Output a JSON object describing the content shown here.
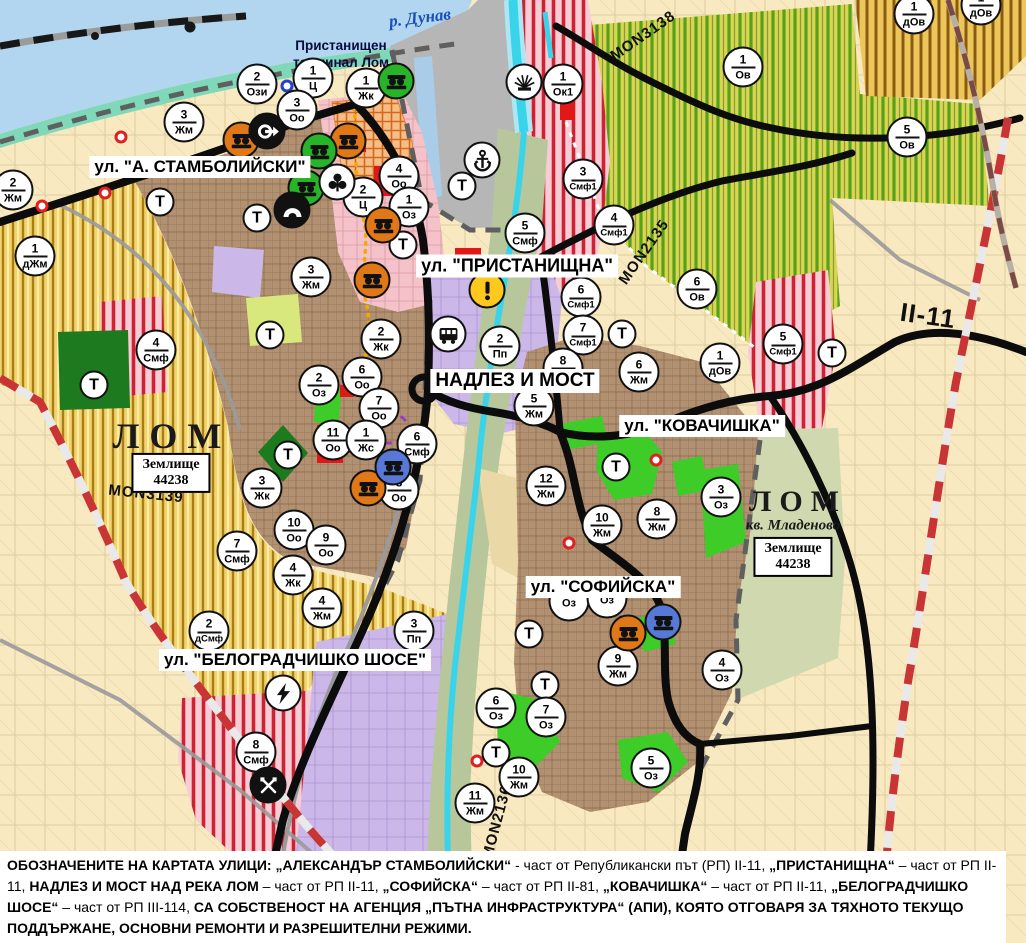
{
  "palette": {
    "water": "#b2d6ef",
    "harbor": "#b6b6b6",
    "shore": "#7fd8b8",
    "cream": "#f8e9c0",
    "gold": "#f3d46a",
    "vine": "#d6d651",
    "urban": "#b29072",
    "pink": "#f4c2c8",
    "red_stripe": "#cc2233",
    "purple": "#cbb8e8",
    "olive": "#b7c79b",
    "pale_olive": "#cfd8ae",
    "sandy": "#ead9a6",
    "dark_green": "#1e7a1e",
    "bright_green": "#3ecc28",
    "lime": "#d8e87c",
    "red_zone": "#e01818",
    "road_black": "#0c0c0c",
    "road_red_dash": "#c93434",
    "cyan": "#3ad4ea",
    "marker_border": "#111111",
    "warning_yellow": "#ffc81e",
    "icon_orange": "#e07818",
    "icon_green": "#28b428",
    "icon_blue": "#5878d8"
  },
  "map": {
    "width": 1026,
    "height": 943,
    "labels": {
      "water": {
        "text": "р. Дунав",
        "x": 420,
        "y": 18
      },
      "port_terminal": {
        "line1": "Пристанищен",
        "line2": "терминал Лом",
        "x": 341,
        "y": 38
      },
      "streets": [
        {
          "text": "ул. \"А. СТАМБОЛИЙСКИ\"",
          "x": 200,
          "y": 167,
          "size": 17
        },
        {
          "text": "ул. \"ПРИСТАНИЩНА\"",
          "x": 517,
          "y": 266,
          "size": 18
        },
        {
          "text": "НАДЛЕЗ И МОСТ",
          "x": 515,
          "y": 381,
          "size": 19
        },
        {
          "text": "ул. \"КОВАЧИШКА\"",
          "x": 702,
          "y": 426,
          "size": 17
        },
        {
          "text": "ул. \"СОФИЙСКА\"",
          "x": 603,
          "y": 587,
          "size": 17
        },
        {
          "text": "ул. \"БЕЛОГРАДЧИШКО ШОСЕ\"",
          "x": 295,
          "y": 660,
          "size": 17
        }
      ],
      "cities": [
        {
          "text": "ЛОМ",
          "x": 172,
          "y": 436,
          "size": 36,
          "spacing": 10
        },
        {
          "text": "ЛОМ",
          "x": 798,
          "y": 502,
          "size": 30,
          "spacing": 8
        }
      ],
      "quarter": {
        "text": "кв. Младеново",
        "x": 793,
        "y": 526
      },
      "land_registry": [
        {
          "line1": "Землище",
          "line2": "44238",
          "x": 171,
          "y": 473
        },
        {
          "line1": "Землище",
          "line2": "44238",
          "x": 793,
          "y": 557
        }
      ],
      "roads": [
        {
          "text": "MON3139",
          "x": 146,
          "y": 494,
          "rotation": 6,
          "size": 15
        },
        {
          "text": "MON3138",
          "x": 643,
          "y": 36,
          "rotation": -35,
          "size": 15
        },
        {
          "text": "MON2135",
          "x": 644,
          "y": 252,
          "rotation": -55,
          "size": 15
        },
        {
          "text": "MON2136",
          "x": 497,
          "y": 822,
          "rotation": -75,
          "size": 15
        },
        {
          "text": "II-11",
          "x": 928,
          "y": 316,
          "rotation": 8,
          "size": 26
        }
      ]
    },
    "zone_markers": [
      {
        "num": "2",
        "code": "Ози",
        "x": 257,
        "y": 84
      },
      {
        "num": "1",
        "code": "Ц",
        "x": 313,
        "y": 78
      },
      {
        "num": "1",
        "code": "Жк",
        "x": 366,
        "y": 88
      },
      {
        "num": "3",
        "code": "Оо",
        "x": 297,
        "y": 110
      },
      {
        "num": "3",
        "code": "Жм",
        "x": 184,
        "y": 122
      },
      {
        "num": "2",
        "code": "Жм",
        "x": 13,
        "y": 190
      },
      {
        "num": "1",
        "code": "дЖм",
        "x": 35,
        "y": 256
      },
      {
        "num": "4",
        "code": "Смф",
        "x": 156,
        "y": 350
      },
      {
        "num": "1",
        "code": "Ок1",
        "x": 563,
        "y": 84
      },
      {
        "num": "3",
        "code": "Смф1",
        "x": 583,
        "y": 179
      },
      {
        "num": "4",
        "code": "Смф1",
        "x": 614,
        "y": 225
      },
      {
        "num": "4",
        "code": "Оо",
        "x": 399,
        "y": 176
      },
      {
        "num": "2",
        "code": "Ц",
        "x": 363,
        "y": 197
      },
      {
        "num": "1",
        "code": "Оз",
        "x": 409,
        "y": 207
      },
      {
        "num": "5",
        "code": "Смф",
        "x": 525,
        "y": 233
      },
      {
        "num": "6",
        "code": "Смф1",
        "x": 581,
        "y": 297
      },
      {
        "num": "7",
        "code": "Смф1",
        "x": 583,
        "y": 335
      },
      {
        "num": "5",
        "code": "Смф1",
        "x": 783,
        "y": 344
      },
      {
        "num": "1",
        "code": "дОв",
        "x": 720,
        "y": 363
      },
      {
        "num": "6",
        "code": "Ов",
        "x": 697,
        "y": 289
      },
      {
        "num": "1",
        "code": "Ов",
        "x": 743,
        "y": 67
      },
      {
        "num": "5",
        "code": "Ов",
        "x": 907,
        "y": 137
      },
      {
        "num": "1",
        "code": "дОв",
        "x": 914,
        "y": 14
      },
      {
        "num": "1",
        "code": "дОв",
        "x": 981,
        "y": 5
      },
      {
        "num": "3",
        "code": "Жм",
        "x": 311,
        "y": 277
      },
      {
        "num": "2",
        "code": "Жк",
        "x": 381,
        "y": 339
      },
      {
        "num": "2",
        "code": "Пп",
        "x": 500,
        "y": 346
      },
      {
        "num": "6",
        "code": "Оо",
        "x": 362,
        "y": 377
      },
      {
        "num": "2",
        "code": "Оз",
        "x": 319,
        "y": 385
      },
      {
        "num": "7",
        "code": "Оо",
        "x": 379,
        "y": 408
      },
      {
        "num": "11",
        "code": "Оо",
        "x": 333,
        "y": 440
      },
      {
        "num": "1",
        "code": "Жс",
        "x": 366,
        "y": 440
      },
      {
        "num": "6",
        "code": "Смф",
        "x": 417,
        "y": 444
      },
      {
        "num": "8",
        "code": "Оо",
        "x": 399,
        "y": 490
      },
      {
        "num": "3",
        "code": "Жк",
        "x": 262,
        "y": 488
      },
      {
        "num": "10",
        "code": "Оо",
        "x": 294,
        "y": 530
      },
      {
        "num": "9",
        "code": "Оо",
        "x": 326,
        "y": 545
      },
      {
        "num": "7",
        "code": "Смф",
        "x": 237,
        "y": 551
      },
      {
        "num": "4",
        "code": "Жк",
        "x": 293,
        "y": 575
      },
      {
        "num": "4",
        "code": "Жм",
        "x": 322,
        "y": 608
      },
      {
        "num": "2",
        "code": "дСмф",
        "x": 209,
        "y": 631
      },
      {
        "num": "3",
        "code": "Пп",
        "x": 414,
        "y": 631
      },
      {
        "num": "8",
        "code": "Смф",
        "x": 256,
        "y": 752
      },
      {
        "num": "5",
        "code": "Жм",
        "x": 534,
        "y": 406
      },
      {
        "num": "8",
        "code": "Жм",
        "x": 563,
        "y": 368
      },
      {
        "num": "6",
        "code": "Жм",
        "x": 639,
        "y": 372
      },
      {
        "num": "12",
        "code": "Жм",
        "x": 546,
        "y": 486
      },
      {
        "num": "10",
        "code": "Жм",
        "x": 602,
        "y": 525
      },
      {
        "num": "8",
        "code": "Жм",
        "x": 657,
        "y": 519
      },
      {
        "num": "3",
        "code": "Оз",
        "x": 721,
        "y": 497
      },
      {
        "num": "9",
        "code": "Жм",
        "x": 618,
        "y": 666
      },
      {
        "num": "4",
        "code": "Оз",
        "x": 722,
        "y": 670
      },
      {
        "num": "6",
        "code": "Оз",
        "x": 496,
        "y": 708
      },
      {
        "num": "7",
        "code": "Оз",
        "x": 546,
        "y": 717
      },
      {
        "num": "5",
        "code": "Оз",
        "x": 651,
        "y": 768
      },
      {
        "num": "10",
        "code": "Жм",
        "x": 519,
        "y": 777
      },
      {
        "num": "11",
        "code": "Жм",
        "x": 475,
        "y": 803
      },
      {
        "num": "",
        "code": "Оз",
        "x": 569,
        "y": 601
      },
      {
        "num": "",
        "code": "Оз",
        "x": 607,
        "y": 598
      }
    ],
    "transformer_markers": {
      "label": "Т",
      "points": [
        [
          160,
          202
        ],
        [
          257,
          218
        ],
        [
          403,
          245
        ],
        [
          462,
          186
        ],
        [
          270,
          335
        ],
        [
          288,
          455
        ],
        [
          94,
          385
        ],
        [
          616,
          467
        ],
        [
          622,
          334
        ],
        [
          832,
          353
        ],
        [
          529,
          634
        ],
        [
          545,
          685
        ],
        [
          496,
          753
        ]
      ]
    },
    "poi_icons": [
      {
        "kind": "monument-orange",
        "x": 241,
        "y": 140
      },
      {
        "kind": "monument-orange",
        "x": 348,
        "y": 141
      },
      {
        "kind": "monument-orange",
        "x": 383,
        "y": 225
      },
      {
        "kind": "monument-orange",
        "x": 372,
        "y": 280
      },
      {
        "kind": "monument-orange",
        "x": 368,
        "y": 488
      },
      {
        "kind": "monument-orange",
        "x": 628,
        "y": 633
      },
      {
        "kind": "monument-green",
        "x": 396,
        "y": 81
      },
      {
        "kind": "monument-green",
        "x": 319,
        "y": 151
      },
      {
        "kind": "monument-green",
        "x": 306,
        "y": 188
      },
      {
        "kind": "monument-blue",
        "x": 393,
        "y": 467
      },
      {
        "kind": "monument-blue",
        "x": 663,
        "y": 622
      },
      {
        "kind": "gate-arrow",
        "x": 267,
        "y": 131
      },
      {
        "k­ind": "trefoil",
        "kind": "trefoil",
        "x": 337,
        "y": 182
      },
      {
        "kind": "cave",
        "x": 292,
        "y": 210
      },
      {
        "kind": "anchor",
        "x": 482,
        "y": 160
      },
      {
        "kind": "crane-fan",
        "x": 524,
        "y": 82
      },
      {
        "kind": "warning",
        "x": 487,
        "y": 290
      },
      {
        "kind": "bus-station",
        "x": 448,
        "y": 334
      },
      {
        "kind": "power-lightning",
        "x": 283,
        "y": 693
      },
      {
        "kind": "industrial-cross",
        "x": 268,
        "y": 785
      }
    ],
    "dots": [
      {
        "color": "red",
        "x": 121,
        "y": 137
      },
      {
        "color": "red",
        "x": 105,
        "y": 193
      },
      {
        "color": "red",
        "x": 42,
        "y": 206
      },
      {
        "color": "red",
        "x": 656,
        "y": 460
      },
      {
        "color": "red",
        "x": 569,
        "y": 543
      },
      {
        "color": "red",
        "x": 477,
        "y": 761
      },
      {
        "color": "blue",
        "x": 287,
        "y": 86
      }
    ],
    "note": {
      "segments": [
        {
          "text": "ОБОЗНАЧЕНИТЕ НА КАРТАТА УЛИЦИ: „АЛЕКСАНДЪР СТАМБОЛИЙСКИ“",
          "bold": true
        },
        {
          "text": " - част от Републикански път (РП) II-11, ",
          "bold": false
        },
        {
          "text": "„ПРИСТАНИЩНА“",
          "bold": true
        },
        {
          "text": " – част от РП II-11, ",
          "bold": false
        },
        {
          "text": "НАДЛЕЗ И МОСТ НАД РЕКА ЛОМ",
          "bold": true
        },
        {
          "text": " – част от РП II-11, ",
          "bold": false
        },
        {
          "text": "„СОФИЙСКА“",
          "bold": true
        },
        {
          "text": " – част от РП II-81, ",
          "bold": false
        },
        {
          "text": "„КОВАЧИШКА“",
          "bold": true
        },
        {
          "text": " – част от РП II-11, ",
          "bold": false
        },
        {
          "text": "„БЕЛОГРАДЧИШКО ШОСЕ“",
          "bold": true
        },
        {
          "text": " – част от РП III-114, ",
          "bold": false
        },
        {
          "text": "СА СОБСТВЕНОСТ НА АГЕНЦИЯ „ПЪТНА ИНФРАСТРУКТУРА“ (АПИ), КОЯТО ОТГОВАРЯ ЗА ТЯХНОТО ТЕКУЩО ПОДДЪРЖАНЕ, ОСНОВНИ РЕМОНТИ И РАЗРЕШИТЕЛНИ РЕЖИМИ.",
          "bold": true
        }
      ]
    }
  }
}
